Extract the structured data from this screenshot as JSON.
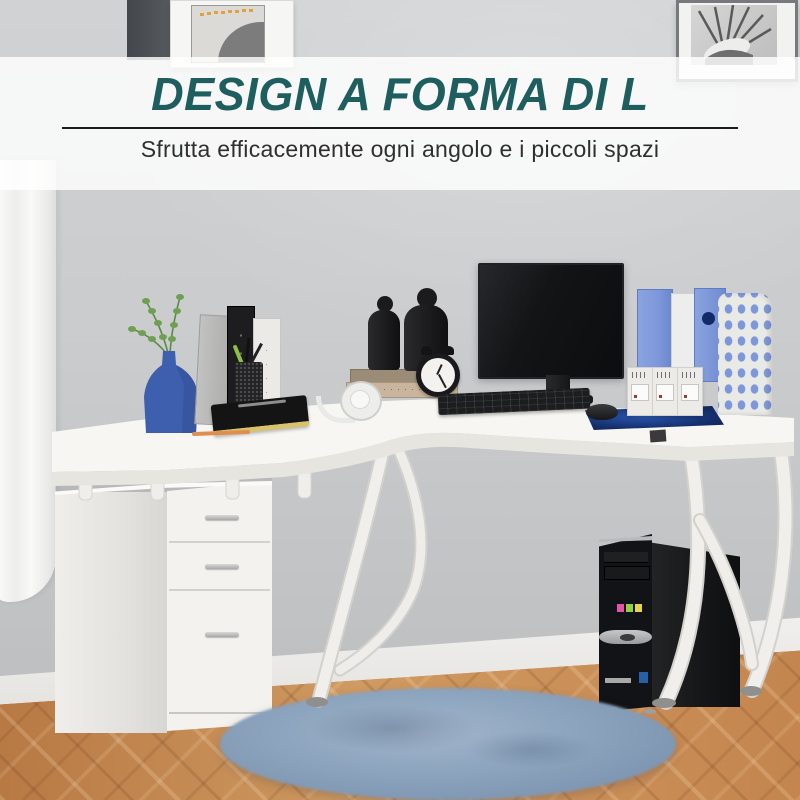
{
  "overlay": {
    "title": "DESIGN A FORMA DI L",
    "subtitle": "Sfrutta efficacemente ogni angolo e i piccoli spazi"
  },
  "colors": {
    "title": "#1e5e5f",
    "subtitle": "#2f2f2f",
    "divider": "#1c1c1c",
    "band": "rgba(255,255,255,0.82)",
    "wall": "#c9cbcd",
    "floor": "#c0824f",
    "rug": "#8ba3bd",
    "desk": "#f6f5f1",
    "binder_blue": "#7d98da",
    "vase_blue": "#3d5fae",
    "plant_green": "#699a4f",
    "pencil_orange": "#dd8f4f"
  }
}
